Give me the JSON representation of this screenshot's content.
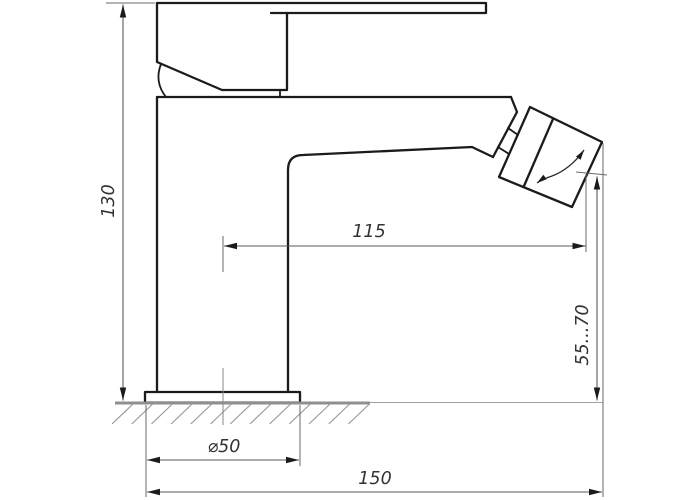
{
  "drawing": {
    "dimensions": {
      "height": {
        "label": "130"
      },
      "spout_reach": {
        "label": "115"
      },
      "aerator_height_range": {
        "label": "55...70"
      },
      "base_diameter": {
        "label": "⌀50"
      },
      "total_depth": {
        "label": "150"
      }
    }
  }
}
